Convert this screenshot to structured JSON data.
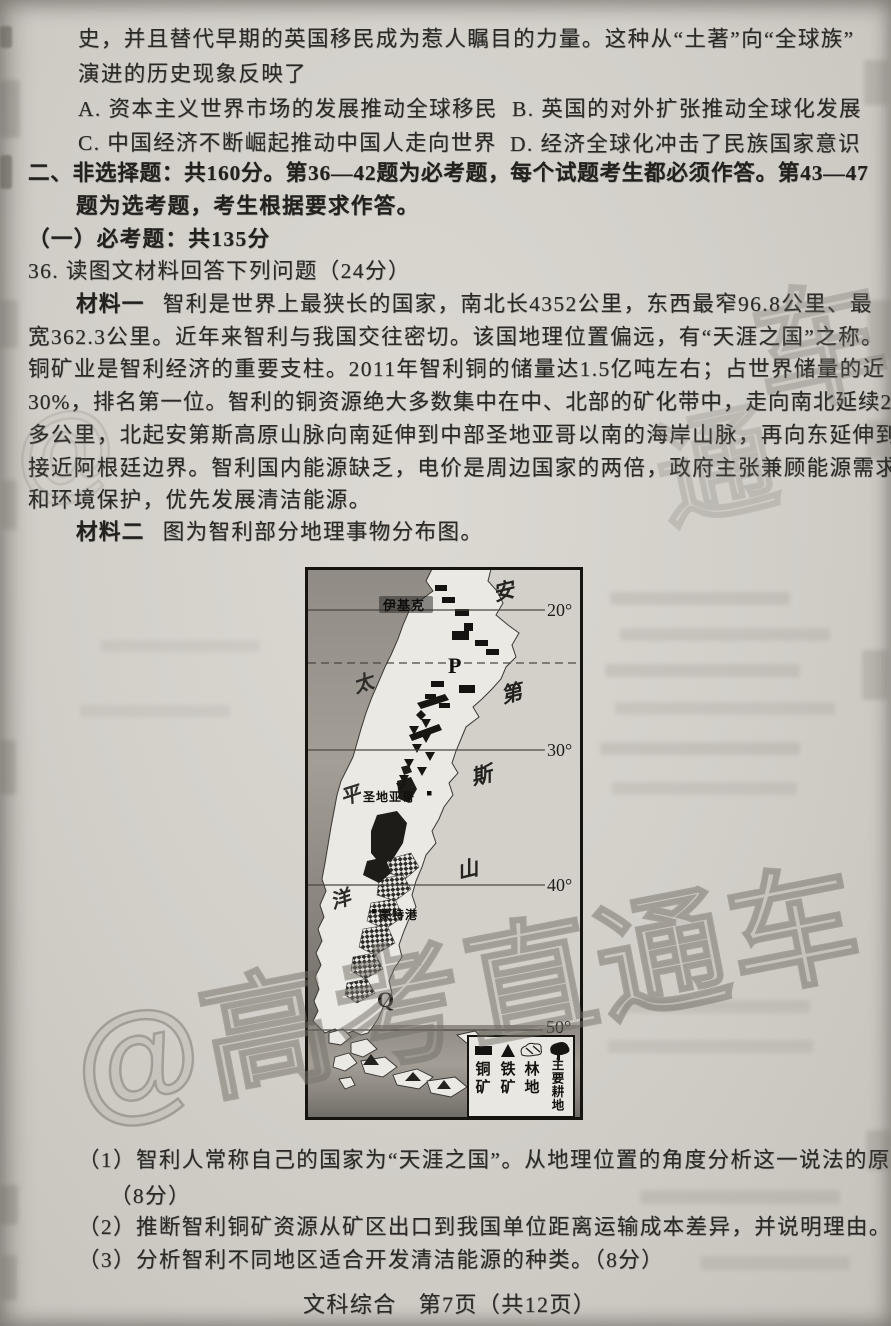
{
  "content": {
    "history": {
      "line1": "史，并且替代早期的英国移民成为惹人瞩目的力量。这种从“土著”向“全球族”",
      "line2": "演进的历史现象反映了",
      "optionA": "A. 资本主义世界市场的发展推动全球移民",
      "optionB": "B. 英国的对外扩张推动全球化发展",
      "optionC": "C. 中国经济不断崛起推动中国人走向世界",
      "optionD": "D. 经济全球化冲击了民族国家意识"
    },
    "section": {
      "line1": "二、非选择题：共160分。第36—42题为必考题，每个试题考生都必须作答。第43—47",
      "line2": "题为选考题，考生根据要求作答。",
      "required": "（一）必考题：共135分"
    },
    "q36": {
      "title": "36. 读图文材料回答下列问题（24分）",
      "m1_label": "材料一",
      "m1_line1": "智利是世界上最狭长的国家，南北长4352公里，东西最窄96.8公里、最",
      "m1_line2": "宽362.3公里。近年来智利与我国交往密切。该国地理位置偏远，有“天涯之国”之称。",
      "m1_line3": "铜矿业是智利经济的重要支柱。2011年智利铜的储量达1.5亿吨左右；占世界储量的近",
      "m1_line4": "30%，排名第一位。智利的铜资源绝大多数集中在中、北部的矿化带中，走向南北延续2000",
      "m1_line5": "多公里，北起安第斯高原山脉向南延伸到中部圣地亚哥以南的海岸山脉，再向东延伸到",
      "m1_line6": "接近阿根廷边界。智利国内能源缺乏，电价是周边国家的两倍，政府主张兼顾能源需求",
      "m1_line7": "和环境保护，优先发展清洁能源。",
      "m2_label": "材料二",
      "m2_text": "图为智利部分地理事物分布图。",
      "sub1_line1": "（1）智利人常称自己的国家为“天涯之国”。从地理位置的角度分析这一说法的原因。",
      "sub1_line2": "（8分）",
      "sub2": "（2）推断智利铜矿资源从矿区出口到我国单位距离运输成本差异，并说明理由。（8分）",
      "sub3": "（3）分析智利不同地区适合开发清洁能源的种类。（8分）"
    },
    "footer": {
      "subject": "文科综合",
      "page": "第7页（共12页）"
    }
  },
  "map": {
    "latitudes": [
      "20°",
      "30°",
      "40°",
      "50°"
    ],
    "ocean_chars": [
      "太",
      "平",
      "洋"
    ],
    "andes_chars": [
      "安",
      "第",
      "斯",
      "山"
    ],
    "cities": {
      "north": "伊基克",
      "middle": "圣地亚哥",
      "south": "蒙特港"
    },
    "points": {
      "p": "P",
      "q": "Q"
    },
    "legend": [
      {
        "symbol": "copper-mine",
        "label": "铜矿"
      },
      {
        "symbol": "iron-mine",
        "label": "铁矿"
      },
      {
        "symbol": "forest-land",
        "label": "林地"
      },
      {
        "symbol": "main-farmland",
        "label": "主要耕地"
      }
    ]
  },
  "watermark": {
    "text": "@高考直通车",
    "fragments": [
      "车",
      "通",
      "@"
    ]
  }
}
